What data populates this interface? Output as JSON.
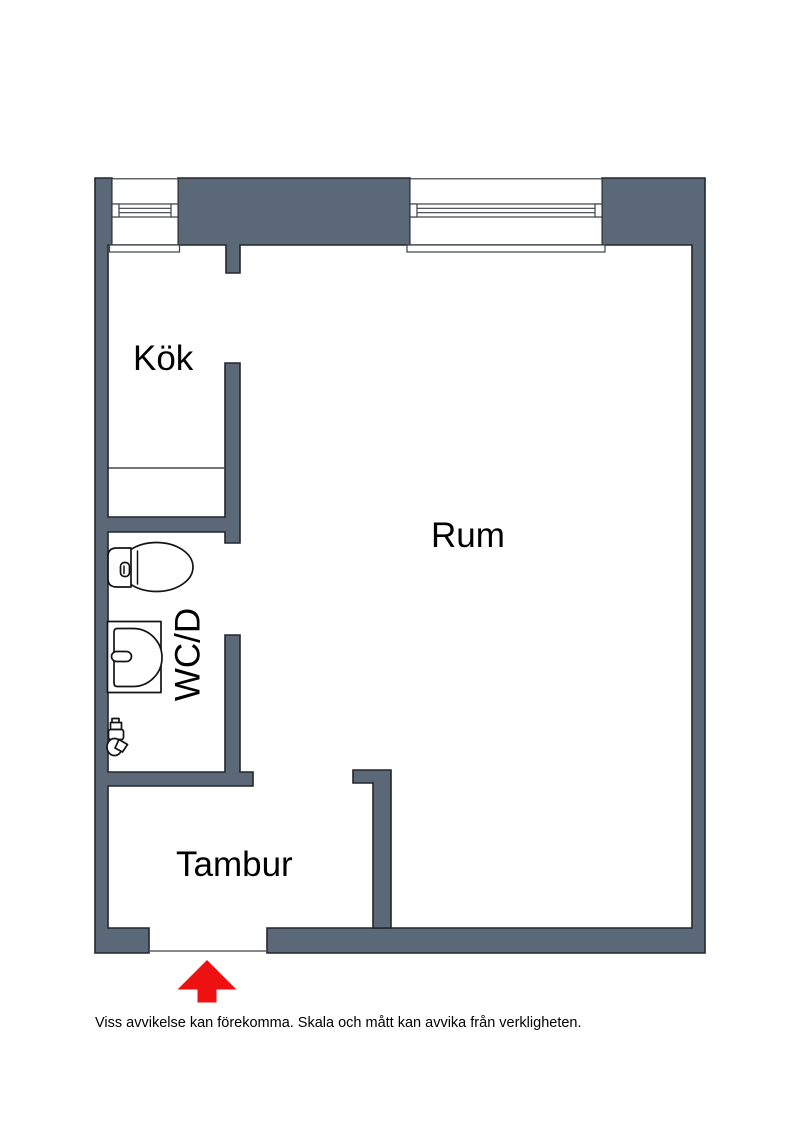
{
  "floor_plan": {
    "rooms": [
      {
        "id": "kok",
        "label": "Kök"
      },
      {
        "id": "rum",
        "label": "Rum"
      },
      {
        "id": "wcd",
        "label": "WC/D"
      },
      {
        "id": "tambur",
        "label": "Tambur"
      }
    ],
    "disclaimer": "Viss avvikelse kan förekomma. Skala och mått kan avvika från verkligheten.",
    "icons": {
      "toilet": "toilet-top-view",
      "sink": "washbasin-top-view",
      "tap": "water-valve",
      "entrance": "entrance-arrow-up",
      "window": "window-double-glass"
    },
    "colors": {
      "wall_fill": "#5b6877",
      "wall_outline": "#22272c",
      "entrance_arrow": "#ed1111",
      "label_text": "#000000"
    }
  }
}
